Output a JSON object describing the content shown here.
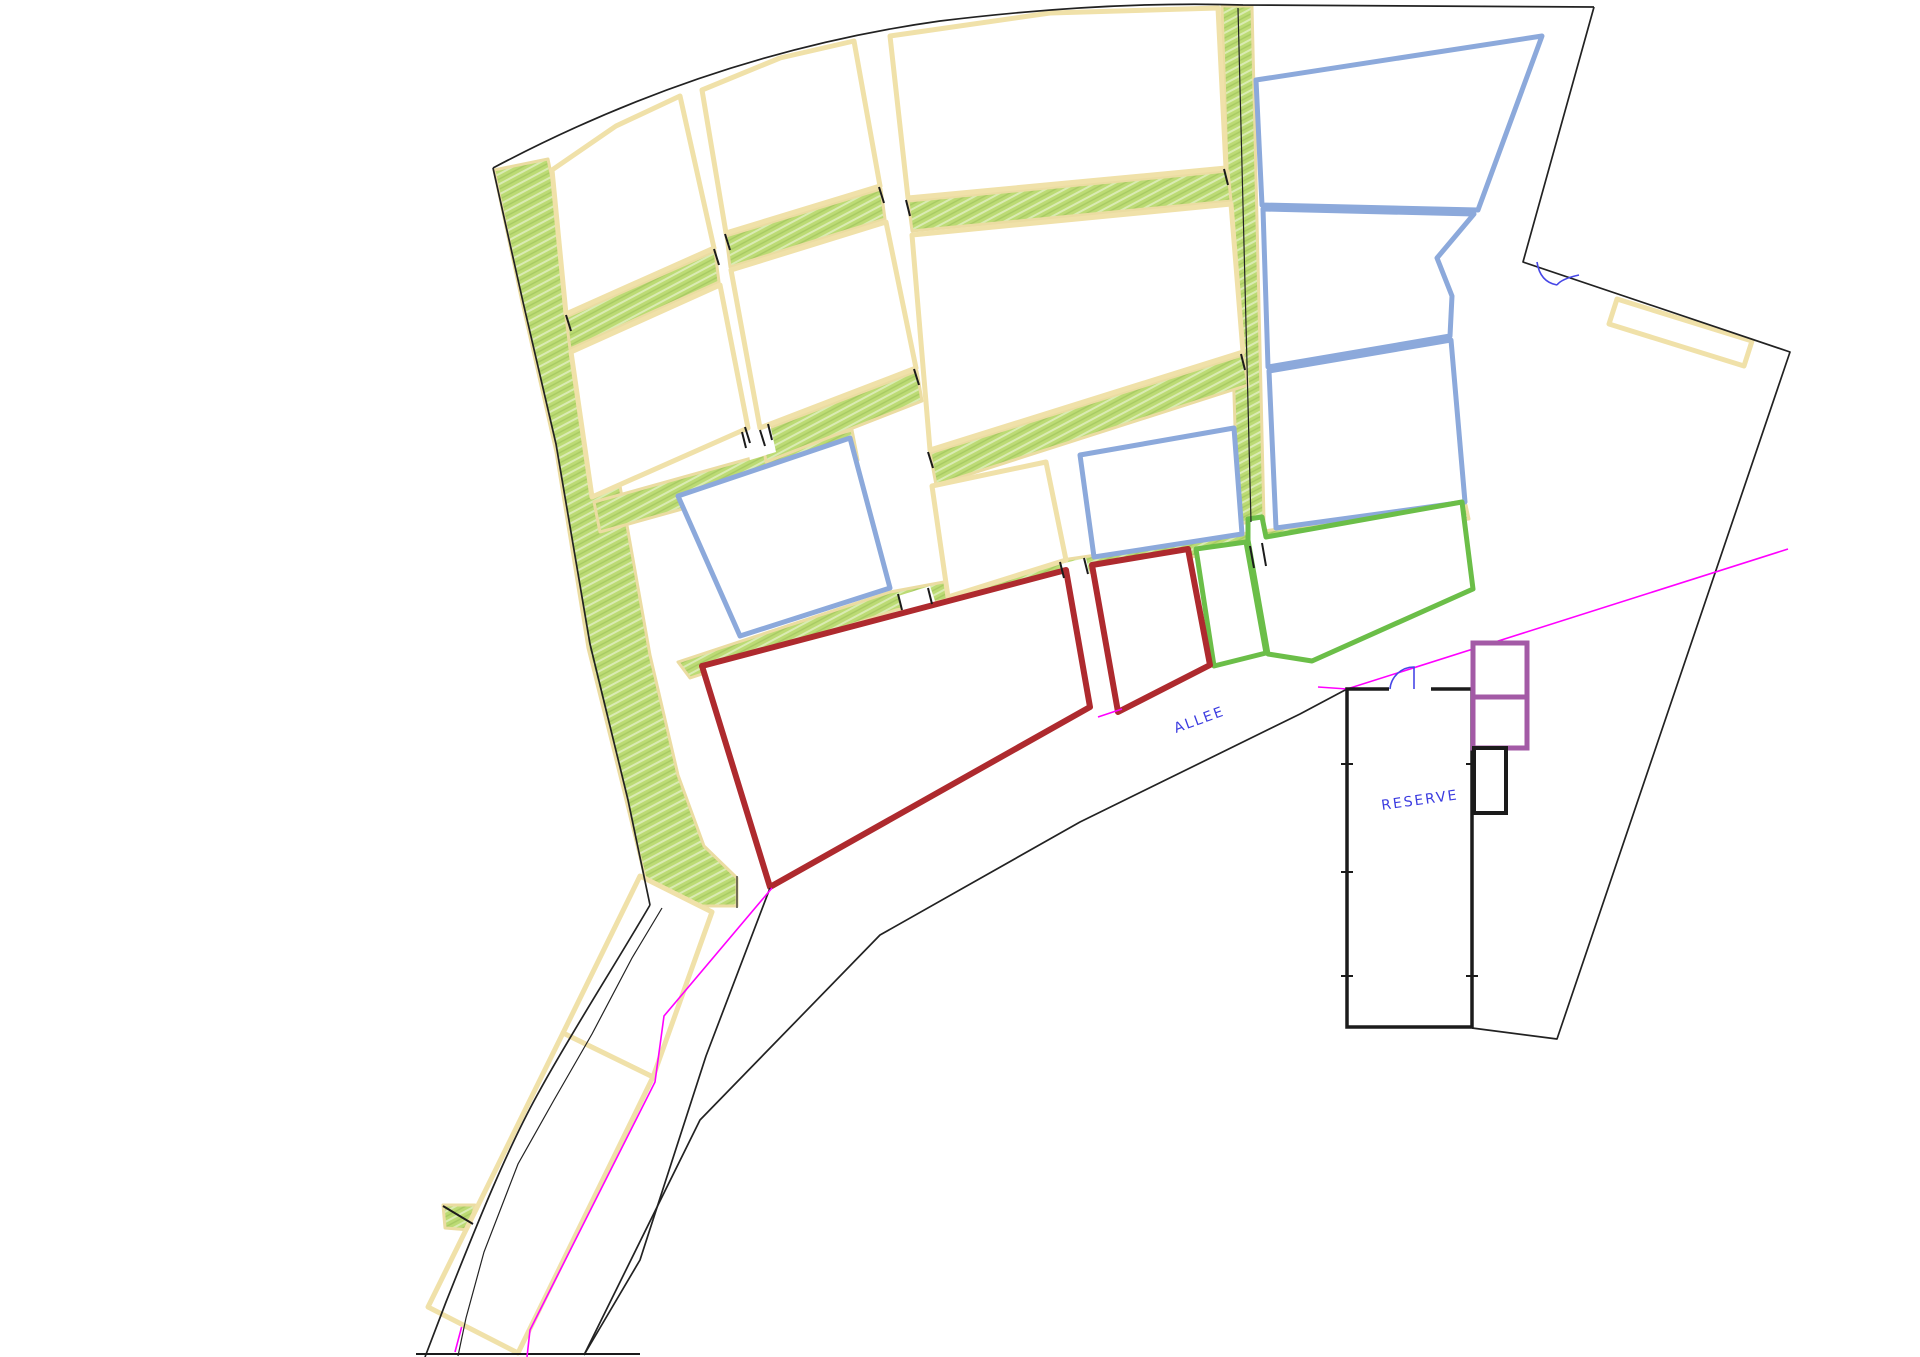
{
  "drawing": {
    "title": "parcel-site-plan",
    "labels": {
      "allee": "ALLEE",
      "reserve": "RESERVE"
    },
    "colors": {
      "background": "#FFFFFF",
      "parcel_cream_stroke": "#F0E1A9",
      "parcel_blue_stroke": "#8CA9DB",
      "parcel_red_stroke": "#AE2A2E",
      "parcel_green_stroke": "#6BBE48",
      "green_strip_fill": "#BCDB74",
      "boundary_black": "#222222",
      "magenta_line": "#FF00FF",
      "purple_annex_stroke": "#A35AA6",
      "label_text_blue": "#3B3BE0"
    },
    "icons": {
      "door_swing": "door-swing-icon",
      "double_door": "double-door-icon",
      "direction_arrows": "direction-arrow-icon"
    }
  }
}
